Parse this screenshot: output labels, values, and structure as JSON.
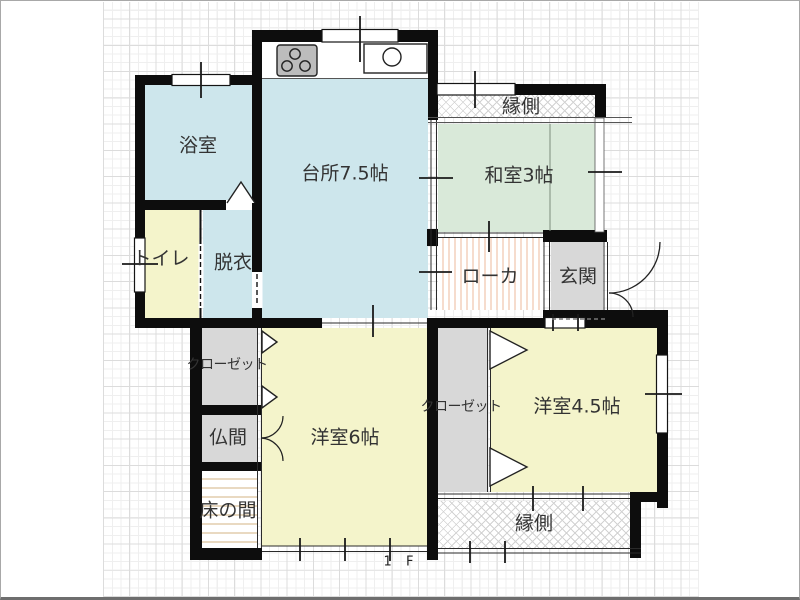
{
  "title": "floor-plan-1f",
  "floor": {
    "label": "1 F"
  },
  "rooms": {
    "bathroom": {
      "label": "浴室"
    },
    "toilet": {
      "label": "トイレ"
    },
    "dressing": {
      "label": "脱衣"
    },
    "kitchen": {
      "label": "台所7.5帖"
    },
    "veranda_top": {
      "label": "縁側"
    },
    "washitsu": {
      "label": "和室3帖"
    },
    "hallway": {
      "label": "ローカ"
    },
    "entrance": {
      "label": "玄関"
    },
    "closet_left": {
      "label": "クローゼット"
    },
    "butsuma": {
      "label": "仏間"
    },
    "tokonoma": {
      "label": "床の間"
    },
    "youshitsu6": {
      "label": "洋室6帖"
    },
    "closet_center": {
      "label": "クローゼット"
    },
    "youshitsu45": {
      "label": "洋室4.5帖"
    },
    "veranda_bottom": {
      "label": "縁側"
    }
  },
  "icons": {
    "stove": "stove-icon",
    "sink": "sink-icon"
  },
  "colors": {
    "wall": "#0d0d0d",
    "water_rooms": "#cde6ec",
    "tatami_room": "#d9e9d9",
    "western_rooms": "#f4f4cb",
    "closet_entrance": "#d8d8d8",
    "text": "#333333"
  }
}
